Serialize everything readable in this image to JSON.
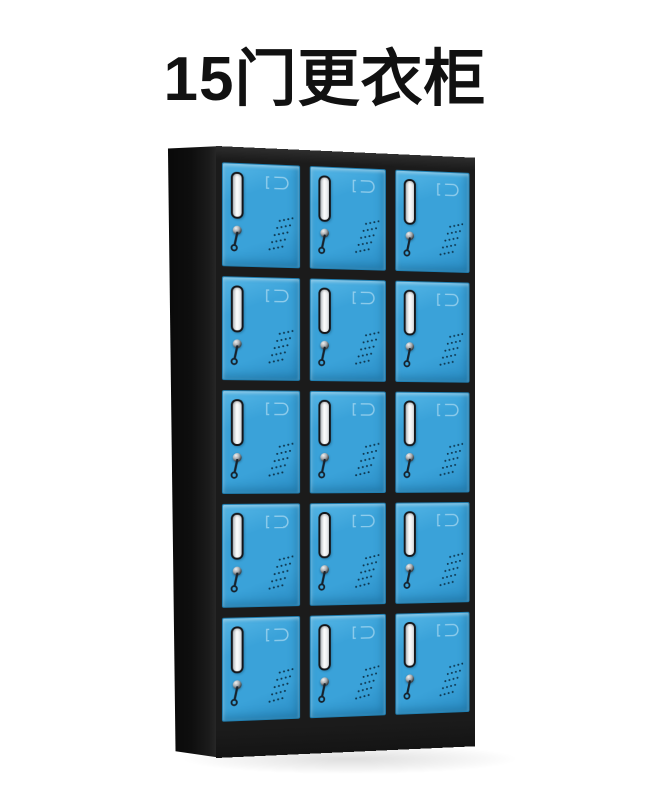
{
  "title": {
    "text": "15门更衣柜"
  },
  "cabinet": {
    "rows": 5,
    "columns": 3,
    "doors_total": 15,
    "door_features": [
      "recessed-handle",
      "key-lock-with-key",
      "name-card-emboss",
      "vent-holes"
    ],
    "colors": {
      "background": "#ffffff",
      "title_color": "#111111",
      "door": "#3aa2d9",
      "door_highlight": "#55b6e6",
      "door_shadow": "#2b8ec6",
      "frame": "#1b1b1b",
      "handle": "#f2f4f5",
      "vent_dot": "#0d3750",
      "key_metal": "#16212b"
    }
  }
}
